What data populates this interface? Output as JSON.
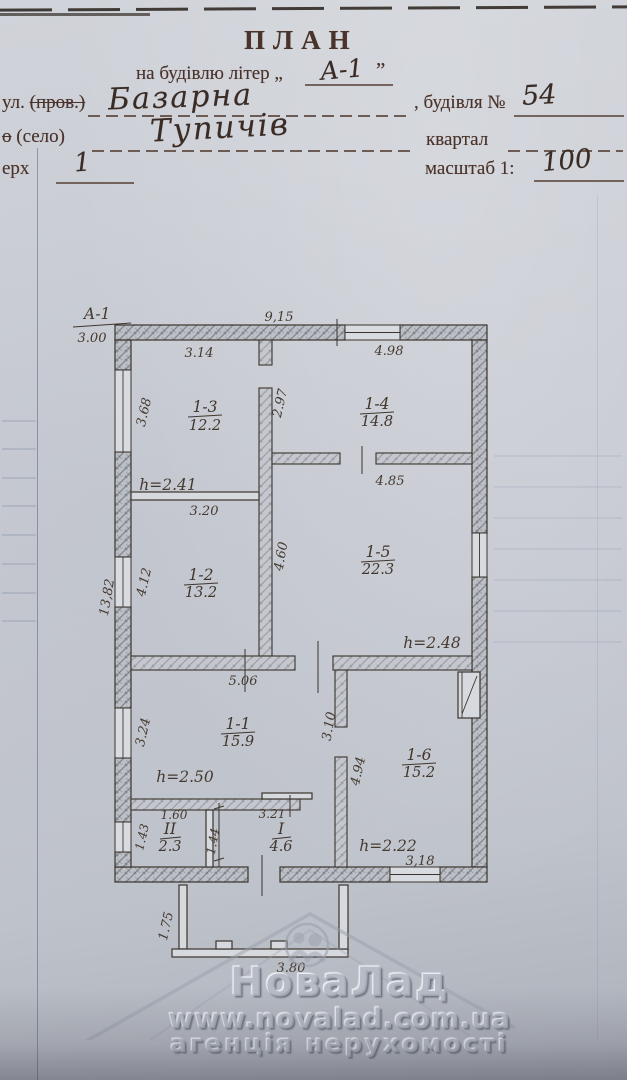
{
  "header": {
    "title": "ПЛАН",
    "line2_prefix": "на будівлю літер „",
    "line2_value": "А-1",
    "line2_suffix": "”",
    "street_label": "ул.",
    "street_struck": "(пров.)",
    "street_value": "Базарна",
    "building_label": ", будівля №",
    "building_value": "54",
    "settlement_struck": "о",
    "settlement_label": "(село)",
    "settlement_value": "Тупичів",
    "kvartal_label": "квартал",
    "floor_label": "ерх",
    "floor_value": "1",
    "scale_label": "масштаб 1:",
    "scale_value": "100"
  },
  "plan": {
    "section": {
      "label": "А-1",
      "height": "3.00"
    },
    "dims": {
      "width_top": "9,15",
      "r13_w": "3.14",
      "r13_h": "3.68",
      "r14_w": "4.98",
      "wall_a_h": "2.97",
      "r15_w": "4.85",
      "r12_w": "3.20",
      "r12_h": "4.12",
      "left_total": "13,82",
      "r15_h": "4.60",
      "r11_w": "5.06",
      "r11_h": "3.24",
      "e_upper": "3.10",
      "e_lower": "4.94",
      "rII_w": "1.60",
      "rII_h": "1.43",
      "partition_h": "1.44",
      "rI_w": "3.21",
      "r16_w": "3,18",
      "porch_h": "1.75",
      "porch_w": "3.80"
    },
    "rooms": {
      "r13": {
        "num": "1-3",
        "area": "12.2"
      },
      "r14": {
        "num": "1-4",
        "area": "14.8"
      },
      "r15": {
        "num": "1-5",
        "area": "22.3"
      },
      "r12": {
        "num": "1-2",
        "area": "13.2"
      },
      "r11": {
        "num": "1-1",
        "area": "15.9"
      },
      "r16": {
        "num": "1-6",
        "area": "15.2"
      },
      "rII": {
        "num": "ІІ",
        "area": "2.3"
      },
      "rI": {
        "num": "І",
        "area": "4.6"
      }
    },
    "heights": {
      "h13": "h=2.41",
      "h15": "h=2.48",
      "h11": "h=2.50",
      "h16": "h=2.22"
    }
  },
  "watermark": {
    "brand": "НоваЛад",
    "url": "www.novalad.com.ua",
    "tagline": "агенція нерухомості"
  }
}
